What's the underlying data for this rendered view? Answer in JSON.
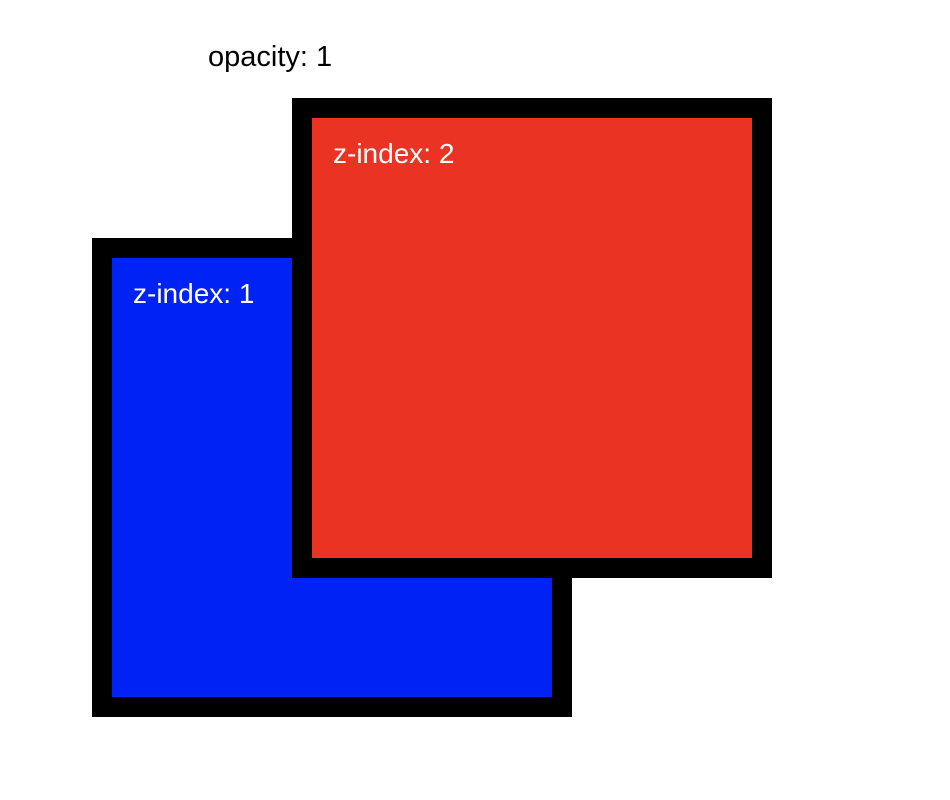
{
  "page": {
    "background_color": "#ffffff"
  },
  "annotation": {
    "opacity_label": "opacity: 1",
    "opacity_label_color": "#000000"
  },
  "boxes": {
    "red": {
      "label": "z-index: 2",
      "z_index": 2,
      "fill_color": "#ea3323",
      "border_color": "#000000",
      "label_color": "#ffffff"
    },
    "blue": {
      "label": "z-index: 1",
      "z_index": 1,
      "fill_color": "#0122f4",
      "border_color": "#000000",
      "label_color": "#ffffff"
    }
  }
}
